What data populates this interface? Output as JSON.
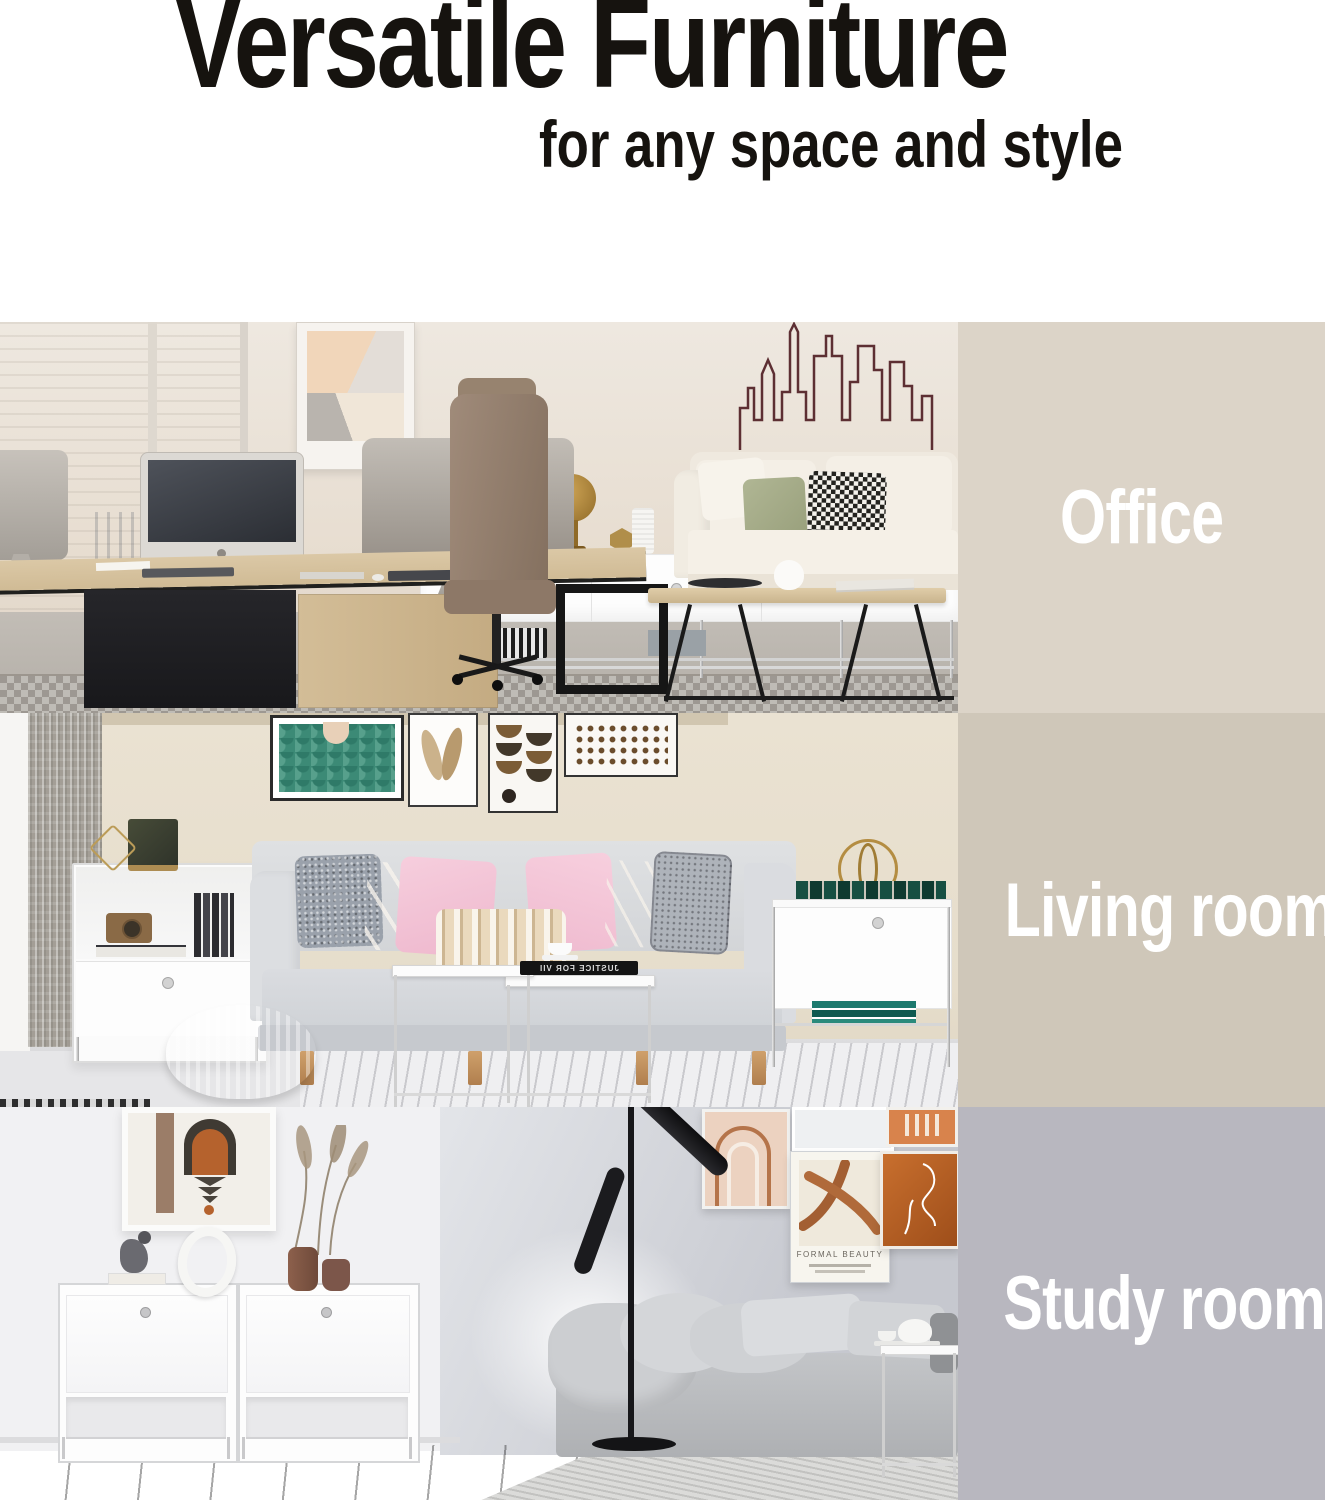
{
  "image_type": "furniture-product-marketing-banner",
  "header": {
    "title": "Versatile Furniture",
    "subtitle": "for any space and style",
    "text_color": "#16130f",
    "background": "#ffffff"
  },
  "sections": [
    {
      "label": "Office",
      "panel_color": "#dcd4c8",
      "label_color": "#ffffff",
      "scene": "office-workspace-photo"
    },
    {
      "label": "Living room",
      "panel_color": "#cfc7b9",
      "label_color": "#ffffff",
      "scene": "living-room-photo"
    },
    {
      "label": "Study room",
      "panel_color": "#b8b7bf",
      "label_color": "#ffffff",
      "scene": "study-room-photo"
    }
  ],
  "scene_text": {
    "poster_text": "FORMAL BEAUTY",
    "book_text": "JUSTICE FOR VII"
  }
}
